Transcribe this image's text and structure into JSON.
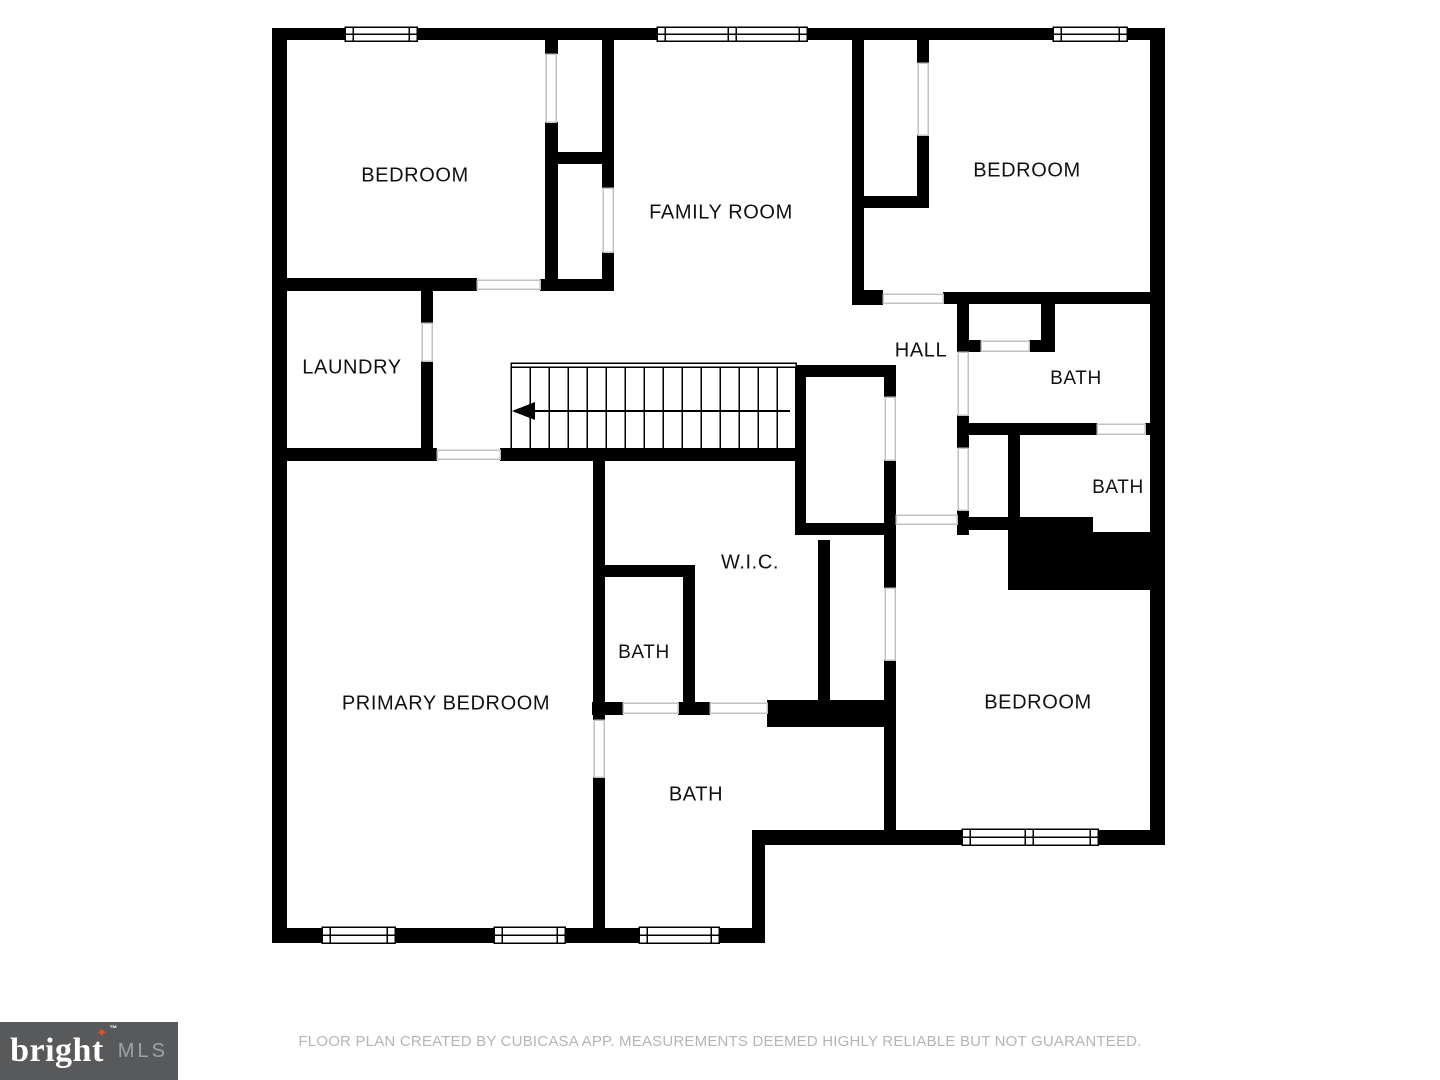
{
  "rooms": [
    {
      "id": "bedroom-top-left",
      "label": "BEDROOM"
    },
    {
      "id": "family-room",
      "label": "FAMILY ROOM"
    },
    {
      "id": "bedroom-top-right",
      "label": "BEDROOM"
    },
    {
      "id": "hall",
      "label": "HALL"
    },
    {
      "id": "bath-upper-right",
      "label": "BATH"
    },
    {
      "id": "bath-right",
      "label": "BATH"
    },
    {
      "id": "laundry",
      "label": "LAUNDRY"
    },
    {
      "id": "walk-in-closet",
      "label": "W.I.C."
    },
    {
      "id": "bath-wic",
      "label": "BATH"
    },
    {
      "id": "primary-bedroom",
      "label": "PRIMARY BEDROOM"
    },
    {
      "id": "bath-primary",
      "label": "BATH"
    },
    {
      "id": "bedroom-bottom-right",
      "label": "BEDROOM"
    }
  ],
  "stairs": {
    "arrow_direction": "left",
    "treads": 15
  },
  "footer": {
    "disclaimer": "FLOOR PLAN CREATED BY CUBICASA APP. MEASUREMENTS DEEMED HIGHLY RELIABLE BUT NOT GUARANTEED."
  },
  "logo": {
    "brand": "bright",
    "tm": "™",
    "star": "✦",
    "suffix": "MLS"
  },
  "colors": {
    "wall": "#000000",
    "door_line": "#c2c2c2",
    "label_text": "#111111",
    "disclaimer_text": "#b5b5b5",
    "logo_bg": "#58595b",
    "logo_brand": "#ffffff",
    "logo_star": "#ef4e23",
    "logo_mls": "#9fa1a4"
  }
}
